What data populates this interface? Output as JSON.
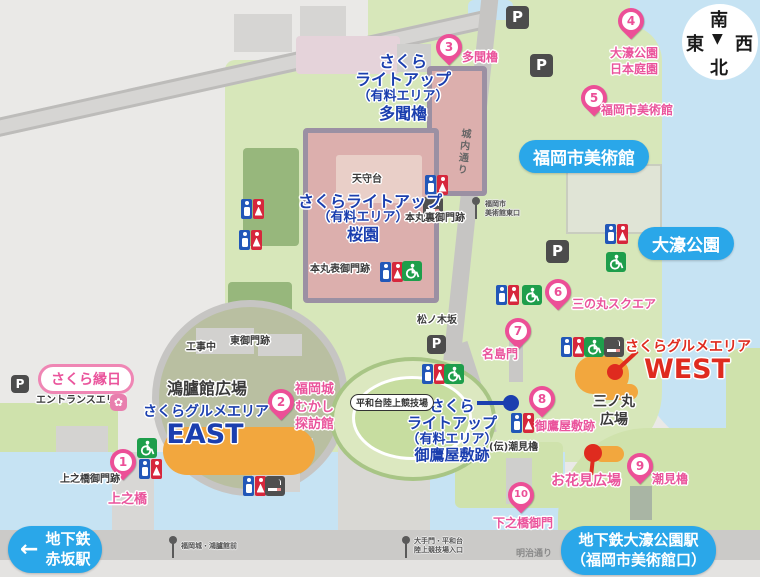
{
  "compass": {
    "top": "南",
    "left": "東",
    "right": "西",
    "bottom": "北",
    "pointer": "▼"
  },
  "badges": {
    "museum": "福岡市美術館",
    "ohori_park": "大濠公園"
  },
  "stations": {
    "akasaka": {
      "arrow": "←",
      "line1": "地下鉄",
      "line2": "赤坂駅"
    },
    "ohori_koen": {
      "line1": "地下鉄大濠公園駅",
      "line2": "（福岡市美術館口）"
    }
  },
  "markers": [
    {
      "num": "1",
      "label_lines": [
        "上之橋"
      ]
    },
    {
      "num": "2",
      "label_lines": [
        "福岡城",
        "むかし",
        "探訪館"
      ]
    },
    {
      "num": "3",
      "label_lines": [
        "多聞櫓"
      ]
    },
    {
      "num": "4",
      "label_lines": [
        "大濠公園",
        "日本庭園"
      ]
    },
    {
      "num": "5",
      "label_lines": [
        "福岡市美術館"
      ]
    },
    {
      "num": "6",
      "label_lines": [
        "三の丸スクエア"
      ]
    },
    {
      "num": "7",
      "label_lines": [
        "名島門"
      ]
    },
    {
      "num": "8",
      "label_lines": [
        "御鷹屋敷跡"
      ]
    },
    {
      "num": "9",
      "label_lines": [
        "潮見櫓"
      ]
    },
    {
      "num": "10",
      "label_lines": [
        "下之橋御門"
      ]
    }
  ],
  "lightup_areas": {
    "tamon": {
      "line1": "さくら",
      "line2": "ライトアップ",
      "line3": "（有料エリア）",
      "line4": "多聞櫓"
    },
    "sakuraen": {
      "line1": "さくらライトアップ",
      "line2": "（有料エリア）",
      "line3": "桜園"
    },
    "otakayashiki": {
      "line1": "さくら",
      "line2": "ライトアップ",
      "line3": "（有料エリア）",
      "line4": "御鷹屋敷跡"
    }
  },
  "gourmet": {
    "east": {
      "name": "さくらグルメエリア",
      "sub": "EAST"
    },
    "west": {
      "name": "さくらグルメエリア",
      "sub": "WEST"
    }
  },
  "areas": {
    "sakura_ennichi": "さくら縁日",
    "entrance_area": "エントランスエリア",
    "korokan_hiroba": "鴻臚館広場",
    "under_construction": "工事中",
    "ohanami_hiroba": "お花見広場",
    "sannomaru_hiroba_line1": "三ノ丸",
    "sannomaru_hiroba_line2": "広場",
    "heiwadai_stadium": "平和台陸上競技場"
  },
  "place_labels": {
    "tenshudai": "天守台",
    "honmaru_ura_gomon": "本丸裏御門跡",
    "honmaru_omote_gomon": "本丸表御門跡",
    "matsunoki_saka": "松ノ木坂",
    "higashi_gomon": "東御門跡",
    "den_shiomiyagura": "(伝)潮見櫓",
    "kaminohashi_gomon": "上之橋御門跡",
    "meiji_dori": "明治通り",
    "jonai_dori": "城内通り"
  },
  "bus_stops": {
    "museum_east_line1": "福岡市",
    "museum_east_line2": "美術館東口",
    "korokan_mae": "福岡城・鴻臚館前",
    "otemon_line1": "大手門・平和台",
    "otemon_line2": "陸上競技場入口"
  },
  "icons": {
    "parking": "P"
  },
  "colors": {
    "pink": "#ea549c",
    "badge_blue": "#2aa7e9",
    "lightup_blue": "#1b3faf",
    "red": "#df2b1f",
    "orange": "#f2a73e",
    "water": "#c6e3f3",
    "park_green": "#d7e7ba"
  }
}
